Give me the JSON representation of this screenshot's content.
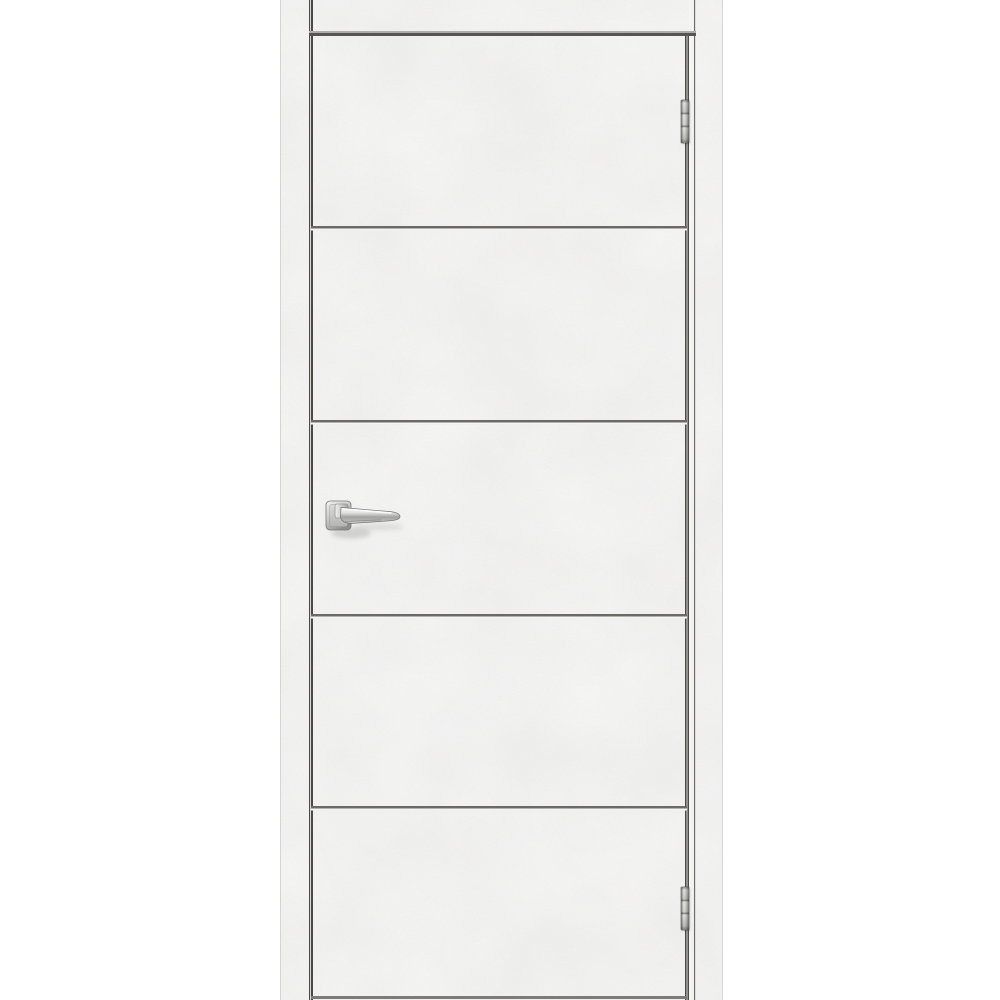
{
  "scene": {
    "type": "product-photo",
    "subject": "interior door with light grey concrete-look finish, framed casing, four horizontal groove moldings, chrome lever handle on the left, two chrome hinges on the right gap",
    "background_color": "#ffffff"
  },
  "palette": {
    "surface_base": "#e2e1df",
    "surface_light": "#ebeae8",
    "surface_dark": "#d2d1cf",
    "seam_dark": "#4b4a47",
    "seam_light": "#d9d8d6",
    "groove_dark": "#6b6a67",
    "groove_highlight": "#f6f6f5",
    "lintel_groove_dark": "#565553",
    "lintel_groove_light": "#aeadab",
    "bottom_edge": "#7c7b79",
    "chrome_highlight": "#f5f5f5",
    "chrome_mid": "#bcbcbc",
    "chrome_dark": "#6f6f6f"
  },
  "geometry": {
    "photo": {
      "left": 280,
      "top": 0,
      "width": 441,
      "height": 1000
    },
    "left_seam_x": 28,
    "right_leaf_edge_x": 404,
    "right_jamb_seam_x": 413,
    "lintel_groove_y": 31,
    "lintel_groove_x": 28,
    "lintel_groove_w": 387,
    "leaf_grooves_y": [
      226,
      420,
      614,
      806
    ],
    "groove_x": 30,
    "groove_w": 376,
    "bottom_edge_y": 996,
    "handle": {
      "x": 40,
      "y": 492,
      "w": 90,
      "h": 52
    },
    "hinge_x": 400,
    "hinge_w": 8,
    "hinge_h": 43,
    "hinges_y": [
      100,
      887
    ]
  }
}
